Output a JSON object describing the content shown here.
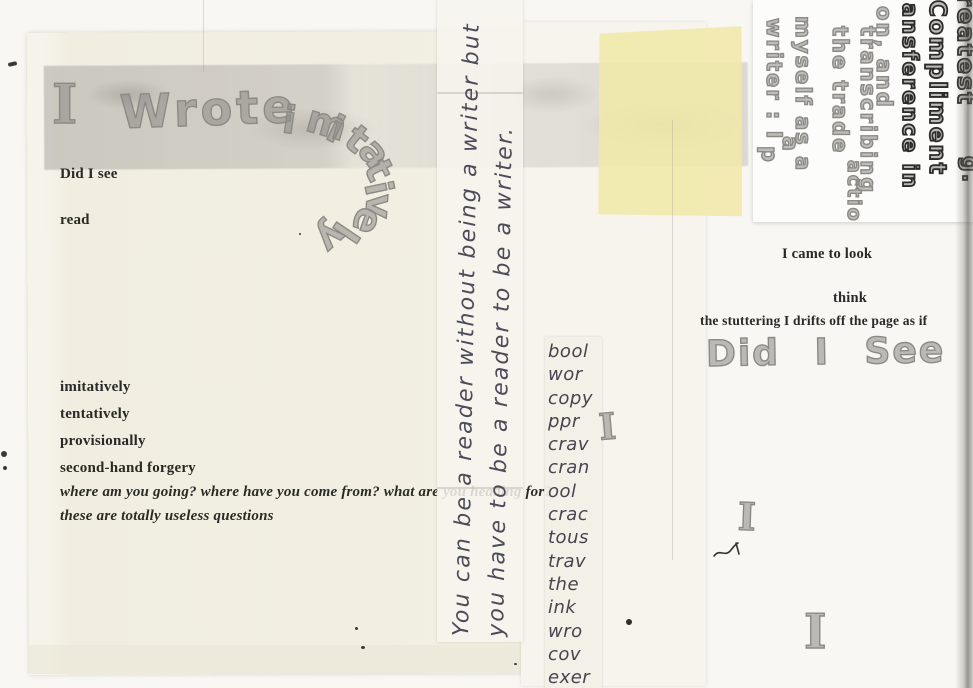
{
  "artwork": {
    "title": {
      "i": "I",
      "wrote": "Wrote",
      "imitatively": "imitatively"
    },
    "left_block": {
      "did_i_see": "Did I see",
      "read": "read",
      "list": [
        "imitatively",
        "tentatively",
        "provisionally",
        "second-hand forgery"
      ],
      "italic_question": "where am you going? where have you come from? what are you heading for?",
      "italic_statement": "these are totally useless questions"
    },
    "vertical_strip": {
      "line1": "You can be a reader without being a writer but",
      "line2": "you have to be a reader to be a writer."
    },
    "fragment_column": [
      "bool",
      "wor",
      "copy",
      "ppr",
      "crav",
      "cran",
      "ool",
      "crac",
      "tous",
      "trav",
      "the",
      "ink",
      "wro",
      "cov",
      "exer"
    ],
    "top_right_block": {
      "fragments": [
        "reatest",
        "Compliment",
        "ansference in",
        "on, and",
        "transcribing",
        "action",
        "the trade",
        "myself as a",
        "writer : I",
        "a",
        "p",
        "g."
      ]
    },
    "right_block": {
      "came_to_look": "I came to look",
      "think": "think",
      "stuttering": "the stuttering I drifts off the page as if",
      "bubble_did_i_see": "Did I See"
    },
    "scattered_i_glyph": "I"
  },
  "colors": {
    "scan_background": "#f8f7f3",
    "sheet_beige": "#f2efe3",
    "smudge_gray": "#cfccc5",
    "yellow_patch": "#f0e8a8",
    "typed_text": "#2a2927",
    "handwriting_ink": "#4c4b5a",
    "bubble_outline": "#8b8a85",
    "bubble_dark_outline": "#2c2b28"
  }
}
